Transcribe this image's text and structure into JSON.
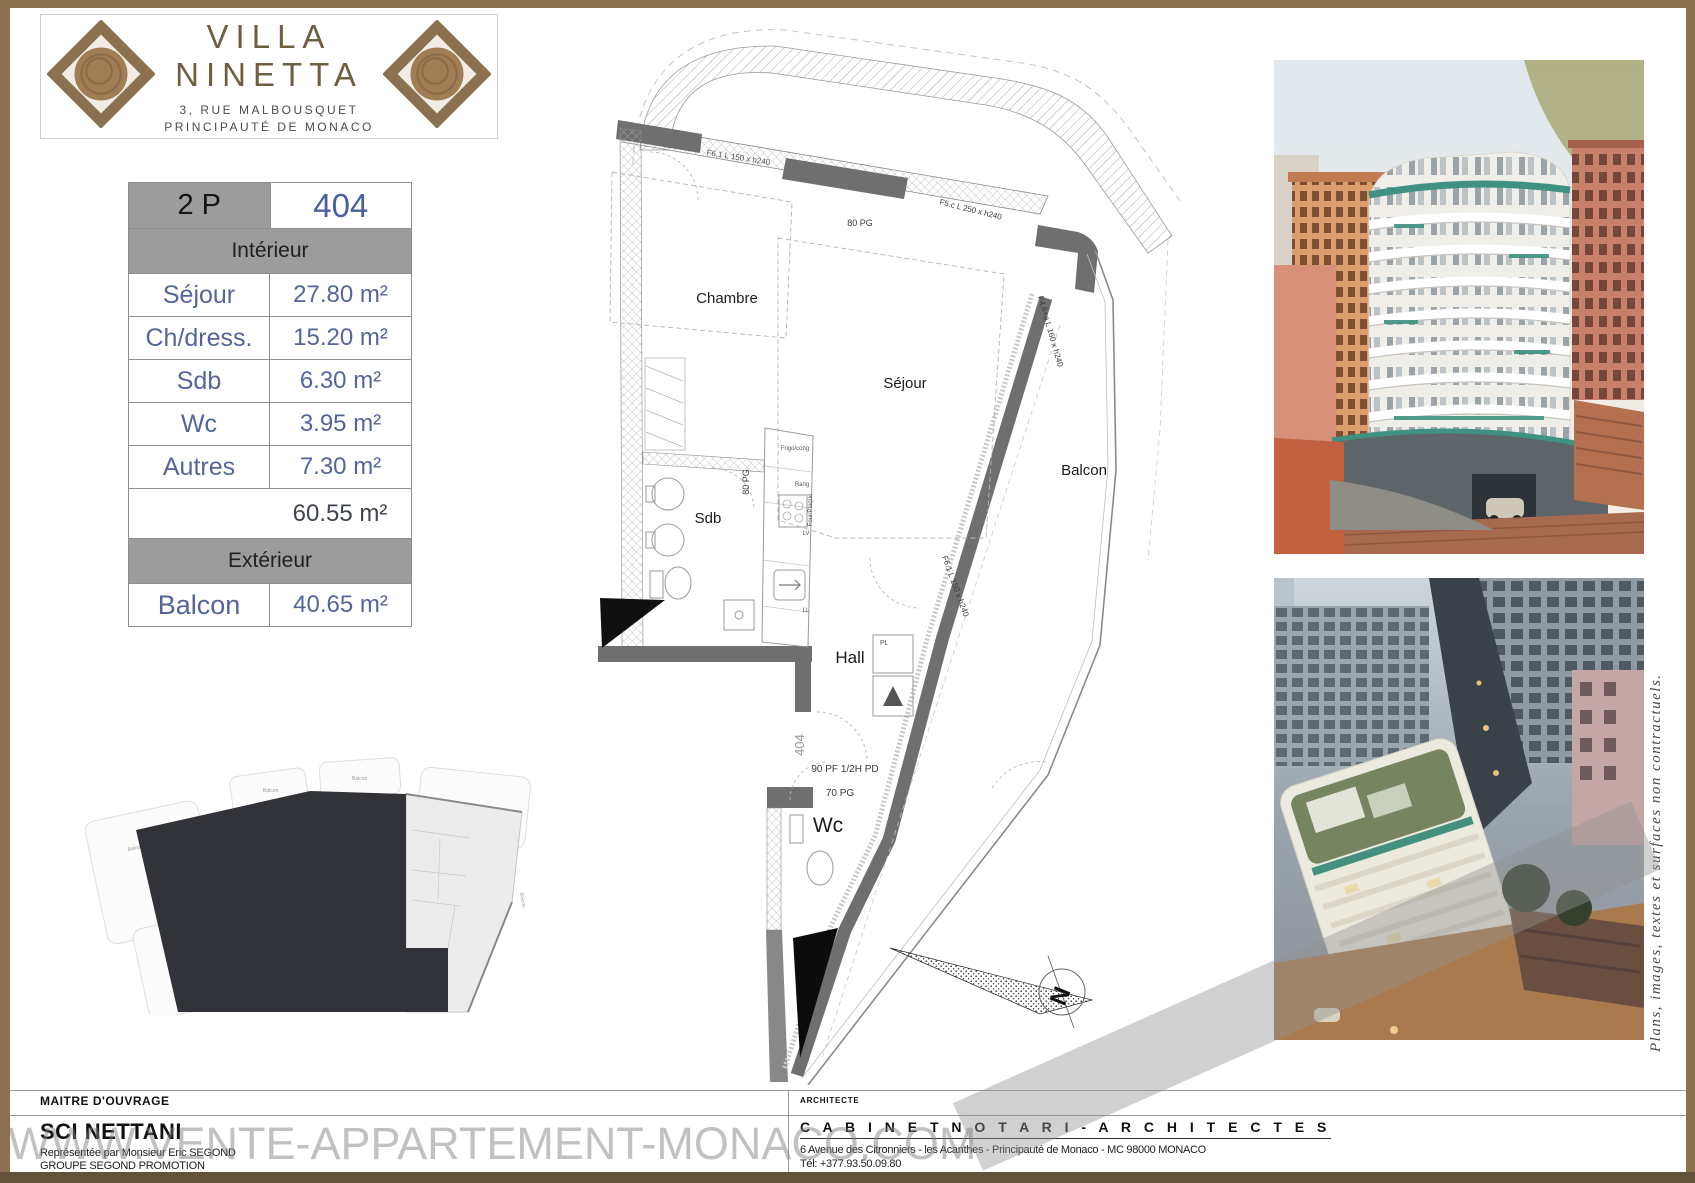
{
  "header": {
    "title": "VILLA NINETTA",
    "address_line1": "3, RUE MALBOUSQUET",
    "address_line2": "PRINCIPAUTÉ DE MONACO"
  },
  "surface_table": {
    "type_label": "2 P",
    "lot_number": "404",
    "interior_label": "Intérieur",
    "rows": [
      {
        "label": "Séjour",
        "value": "27.80 m²"
      },
      {
        "label": "Ch/dress.",
        "value": "15.20 m²"
      },
      {
        "label": "Sdb",
        "value": "6.30 m²"
      },
      {
        "label": "Wc",
        "value": "3.95 m²"
      },
      {
        "label": "Autres",
        "value": "7.30 m²"
      }
    ],
    "interior_total": "60.55 m²",
    "exterior_label": "Extérieur",
    "exterior_rows": [
      {
        "label": "Balcon",
        "value": "40.65 m²"
      }
    ]
  },
  "floor_plan": {
    "rooms": {
      "chambre": "Chambre",
      "sejour": "Séjour",
      "balcon": "Balcon",
      "sdb": "Sdb",
      "hall": "Hall",
      "wc": "Wc"
    },
    "annotations": {
      "pg80_top": "80 PG",
      "pg80_kitchen": "80 PG",
      "window_f5": "F5.c  L 250 x h240",
      "window_f46": "F4.6+a  L 160 x h240",
      "window_f61_right": "F6.1 L 150 x h240",
      "window_f61_top": "F6.1 L 150 x h240",
      "door_pf90": "90 PF 1/2H PD",
      "door_pg70": "70 PG",
      "unit_number": "404",
      "closet": "PL",
      "fridge": "Frigo/cong",
      "storage": "Rang",
      "oven": "Four/Plaque",
      "dishwasher": "LV",
      "laundry": "LL"
    },
    "compass_north": "N"
  },
  "key_plan": {
    "balcon_labels": [
      "Balcon",
      "Balcon",
      "Balcon",
      "Balcon"
    ]
  },
  "side_note": "Plans, images, textes et surfaces non contractuels.",
  "watermark": "WWW.VENTE-APPARTEMENT-MONACO.COM",
  "footer": {
    "owner": {
      "section_label": "MAITRE D'OUVRAGE",
      "name": "SCI NETTANI",
      "lines": [
        "Représentée par Monsieur Eric SEGOND",
        "GROUPE SEGOND PROMOTION",
        "45 Rue Grimaldi - 98 000 Monaco -  Tél: +377.92.05.35.77"
      ]
    },
    "architect": {
      "section_label": "ARCHITECTE",
      "name": "C A B I N E T   N O T A R I  -  A R C H I T E C T E S",
      "lines": [
        "6 Avenue des Citronniers - les Acanthes - Principauté de Monaco - MC 98000 MONACO",
        "Tél: +377.93.50.09.80"
      ]
    }
  },
  "colors": {
    "brand_brown": "#8c7150",
    "frame_bottom_brown": "#63513a",
    "table_gray": "#9c9c9c",
    "table_blue": "#4a5f9e",
    "teal_accent": "#3f9181"
  }
}
